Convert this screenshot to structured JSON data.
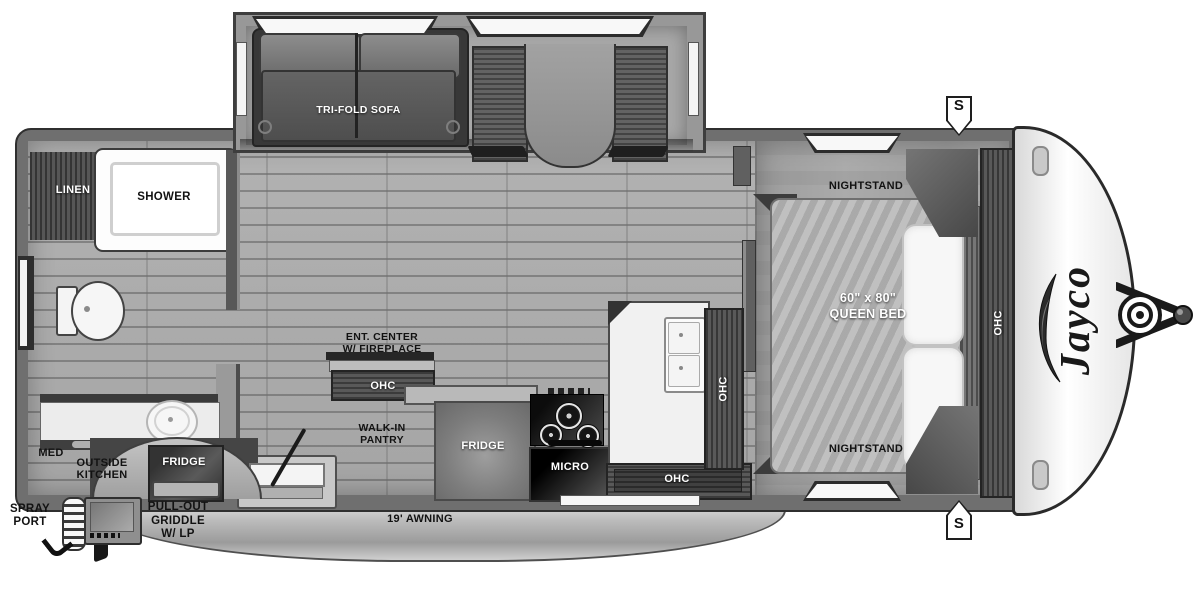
{
  "floorplan": {
    "brand_logo": "Jayco",
    "speaker_top": "S",
    "speaker_bottom": "S",
    "bathroom": {
      "linen": "LINEN",
      "shower": "SHOWER",
      "med": "MED"
    },
    "living": {
      "sofa": "TRI-FOLD SOFA",
      "ent_center_line1": "ENT. CENTER",
      "ent_center_line2": "W/ FIREPLACE",
      "ent_ohc": "OHC",
      "pantry_line1": "WALK-IN",
      "pantry_line2": "PANTRY"
    },
    "kitchen": {
      "fridge": "FRIDGE",
      "micro": "MICRO",
      "ohc_vertical": "OHC",
      "ohc_lower": "OHC"
    },
    "bedroom": {
      "nightstand_top": "NIGHTSTAND",
      "nightstand_bottom": "NIGHTSTAND",
      "bed_size": "60\" x 80\"",
      "bed_type": "QUEEN BED",
      "ohc": "OHC"
    },
    "exterior": {
      "outside_kitchen_line1": "OUTSIDE",
      "outside_kitchen_line2": "KITCHEN",
      "outside_fridge": "FRIDGE",
      "spray_line1": "SPRAY",
      "spray_line2": "PORT",
      "griddle_line1": "PULL-OUT",
      "griddle_line2": "GRIDDLE",
      "griddle_line3": "W/ LP",
      "awning": "19' AWNING"
    }
  },
  "colors": {
    "wall": "#6f6f6f",
    "floor": "#ababab",
    "dark_wood": "#4f4f4f",
    "appliance_black": "#151515",
    "white_fixture": "#f2f2f2",
    "awning_gray": "#b9b9b9",
    "label_dark": "#121212",
    "label_light": "#ffffff"
  }
}
